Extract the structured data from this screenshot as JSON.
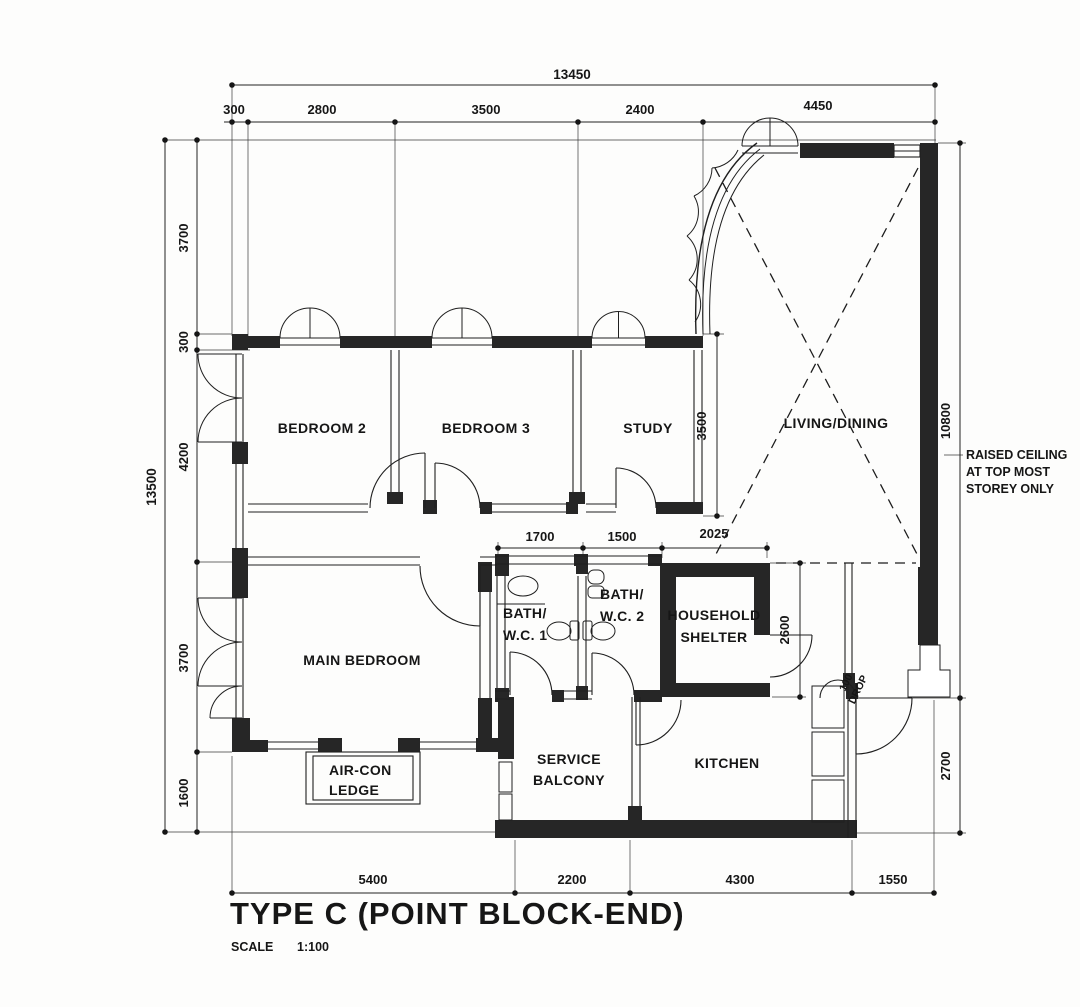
{
  "drawing": {
    "title": "TYPE C (POINT BLOCK-END)",
    "scale_label": "SCALE",
    "scale_value": "1:100"
  },
  "rooms": {
    "bedroom2": "BEDROOM 2",
    "bedroom3": "BEDROOM 3",
    "study": "STUDY",
    "living_dining": "LIVING/DINING",
    "main_bedroom": "MAIN BEDROOM",
    "bath1_line1": "BATH/",
    "bath1_line2": "W.C. 1",
    "bath2_line1": "BATH/",
    "bath2_line2": "W.C. 2",
    "shelter_line1": "HOUSEHOLD",
    "shelter_line2": "SHELTER",
    "service_line1": "SERVICE",
    "service_line2": "BALCONY",
    "kitchen": "KITCHEN",
    "aircon_line1": "AIR-CON",
    "aircon_line2": "LEDGE"
  },
  "annotations": {
    "raised_ceiling_line1": "RAISED CEILING",
    "raised_ceiling_line2": "AT TOP MOST",
    "raised_ceiling_line3": "STOREY ONLY",
    "drop_line1": "100",
    "drop_line2": "DROP"
  },
  "dimensions": {
    "top_total": "13450",
    "top": [
      "300",
      "2800",
      "3500",
      "2400",
      "4450"
    ],
    "left_total": "13500",
    "left": [
      "3700",
      "300",
      "4200",
      "3700",
      "1600"
    ],
    "bottom": [
      "5400",
      "2200",
      "4300",
      "1550"
    ],
    "right": [
      "10800",
      "2700"
    ],
    "interior": {
      "bath1_width": "1700",
      "bath2_width": "1500",
      "shelter_width": "2025",
      "shelter_height": "2600",
      "study_height": "3500"
    }
  }
}
